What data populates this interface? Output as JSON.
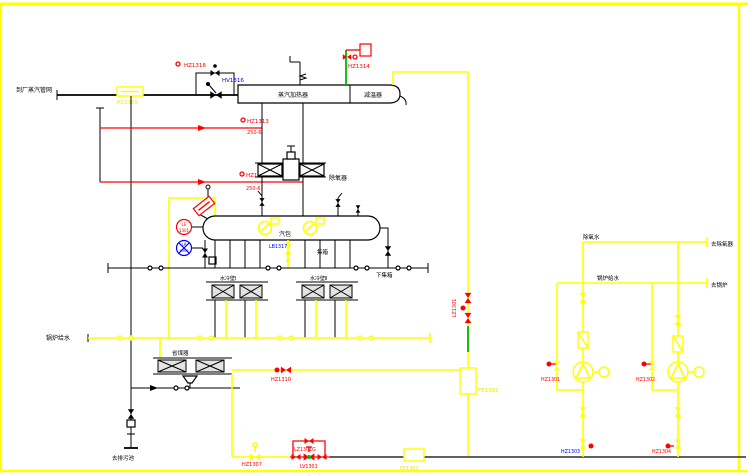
{
  "colors": {
    "frame_yellow": "#ffff00",
    "pipe_yellow": "#ffff00",
    "line_red": "#ff0000",
    "line_green": "#00b800",
    "line_black": "#000000",
    "bottom_header_dark": "#4a4a4a",
    "tag_blue": "#0000ff",
    "background": "#ffffff"
  },
  "icons": [
    "gate-valve-icon",
    "control-valve-icon",
    "check-valve-icon",
    "safety-valve-icon",
    "pump-icon",
    "motor-icon",
    "strainer-icon",
    "level-gauge-icon",
    "instrument-circle-icon",
    "flow-element-box-icon",
    "flange-pair-icon",
    "flow-arrow-icon",
    "hatched-header-icon"
  ],
  "tags": {
    "steam_source": "到厂蒸汽管网",
    "pc1305": "PC1305",
    "hz1318": "HZ1318",
    "hv1316": "HV1316",
    "vessel_left": "蒸汽加热器",
    "vessel_right": "减温器",
    "hz1314": "HZ1314",
    "hz1313": "HZ1313",
    "hz1313_spec": "250-6",
    "hz1312": "HZ1312",
    "hz1312_spec": "250-6",
    "deaerator": "除氧器",
    "drum": "汽包",
    "lb1317": "LB1317",
    "jixiang": "集箱",
    "lower_header": "下集箱",
    "waterwall_left": "水冷壁Ⅰ",
    "waterwall_right": "水冷壁Ⅱ",
    "economizer": "省煤器",
    "hz1310": "HZ1310",
    "hz1307": "HZ1307",
    "lz1301g": "LZ1301G",
    "lv1301": "LV1301",
    "fe1301": "FE1301",
    "fe1302": "FE1302",
    "lz1301_vertical": "LZ1301",
    "hz1303": "HZ1303",
    "hz1304": "HZ1304",
    "hz1301": "HZ1301",
    "hz1302": "HZ1302",
    "lineA_left": "除氧水",
    "lineA_right": "去除氧器",
    "lineB_left": "锅炉给水",
    "lineB_right": "去锅炉",
    "feedwater_header": "锅炉给水",
    "blowdown": "去排污池",
    "le_line1": "LE",
    "le_line2": "1301",
    "la_line1": "LA",
    "la_line2": "1302"
  }
}
